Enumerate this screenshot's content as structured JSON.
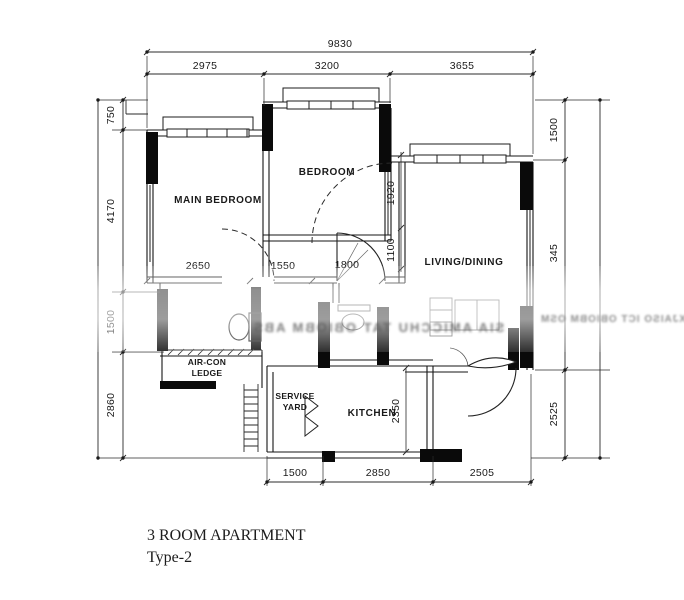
{
  "title": {
    "line1": "3 ROOM APARTMENT",
    "line2": "Type-2"
  },
  "rooms": {
    "main_bedroom": "MAIN BEDROOM",
    "bedroom": "BEDROOM",
    "living_dining": "LIVING/DINING",
    "kitchen": "KITCHEN",
    "service_yard_line1": "SERVICE",
    "service_yard_line2": "YARD",
    "aircon_line1": "AIR-CON",
    "aircon_line2": "LEDGE"
  },
  "dimensions": {
    "top_total": "9830",
    "top": [
      "2975",
      "3200",
      "3655"
    ],
    "left": [
      "750",
      "4170",
      "1500",
      "2860"
    ],
    "right": [
      "1500",
      "345",
      "2525"
    ],
    "bottom": [
      "1500",
      "2850",
      "2505"
    ],
    "interior": {
      "main_bedroom_width": "2650",
      "corridor": "1550",
      "bath_door": "1800",
      "bedroom_wall": "1920",
      "recess": "1100",
      "kitchen_depth": "2350"
    }
  },
  "watermark": {
    "line1": "SIA AMICCHU TAT OBIOBM ABS",
    "line2": "XJAISO ICT OBIOBM OSM"
  },
  "colors": {
    "ink": "#1a1a1a",
    "wall_fill": "#0a0a0a",
    "paper": "#ffffff"
  }
}
